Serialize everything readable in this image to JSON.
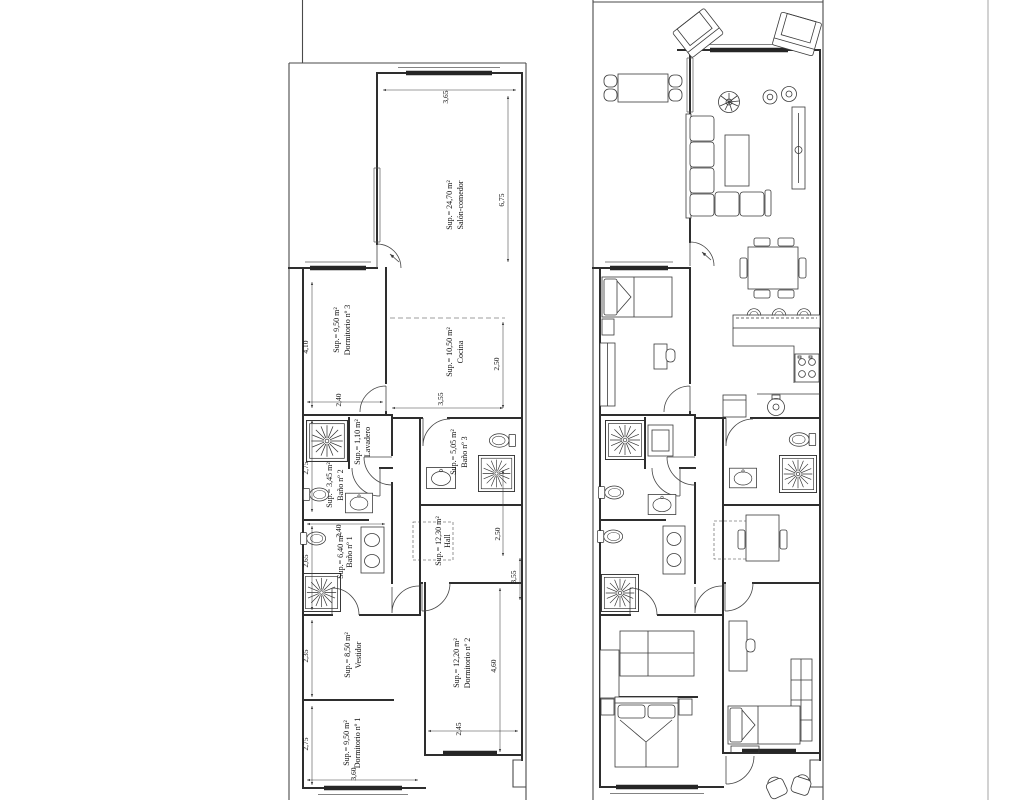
{
  "page": {
    "background": "#ffffff",
    "ink": "#2e2e2e"
  },
  "left_plan": {
    "rooms": {
      "salon": {
        "name": "Salón-comedor",
        "area": "Sup.= 24,70 m²"
      },
      "cocina": {
        "name": "Cocina",
        "area": "Sup.= 10,50 m²"
      },
      "dorm3": {
        "name": "Dormitorio nº 3",
        "area": "Sup.= 9,50 m²"
      },
      "lavadero": {
        "name": "Lavadero",
        "area": "Sup.= 1,10 m²"
      },
      "bano3": {
        "name": "Baño nº 3",
        "area": "Sup.= 5,05 m²"
      },
      "bano2": {
        "name": "Baño nº 2",
        "area": "Sup.= 3,45 m²"
      },
      "bano1": {
        "name": "Baño nº 1",
        "area": "Sup.= 6,40 m²"
      },
      "hall": {
        "name": "Hall",
        "area": "Sup.= 12,30 m²"
      },
      "vestidor": {
        "name": "Vestidor",
        "area": "Sup.= 8,50 m²"
      },
      "dorm2": {
        "name": "Dormitorio nº 2",
        "area": "Sup.= 12,20 m²"
      },
      "dorm1": {
        "name": "Dormitorio nº 1",
        "area": "Sup.= 9,50 m²"
      }
    },
    "dims": {
      "salon_width": "3,65",
      "salon_height": "6,75",
      "dorm3_height": "4,10",
      "dorm3_width": "2,40",
      "cocina_height": "2,50",
      "cocina_width": "3,55",
      "bano2_height": "2,75",
      "bano1_height": "2,65",
      "bano1_width": "2,40",
      "hall_height": "2,50",
      "hall_width": "3,55",
      "vestidor_height": "2,35",
      "dorm2_height": "4,60",
      "dorm2_width": "2,45",
      "dorm1_height": "2,75",
      "dorm1_width": "3,60"
    },
    "fixtures": [
      "shower-tray",
      "toilet",
      "washbasin",
      "double-washbasin"
    ]
  },
  "right_plan": {
    "fixtures": [
      "armchair",
      "outdoor-dining-table",
      "corner-sofa",
      "coffee-table",
      "tv-sideboard",
      "plant",
      "hifi-speakers",
      "dining-table",
      "breakfast-bar",
      "bar-stool",
      "kitchen-counter",
      "cooktop",
      "kitchen-sink",
      "dishwasher",
      "washing-machine",
      "shower-tray",
      "toilet",
      "washbasin",
      "double-washbasin",
      "single-bed",
      "double-bed",
      "nightstand",
      "wardrobe",
      "desk",
      "chair",
      "hall-rug",
      "terrace-chair"
    ]
  }
}
